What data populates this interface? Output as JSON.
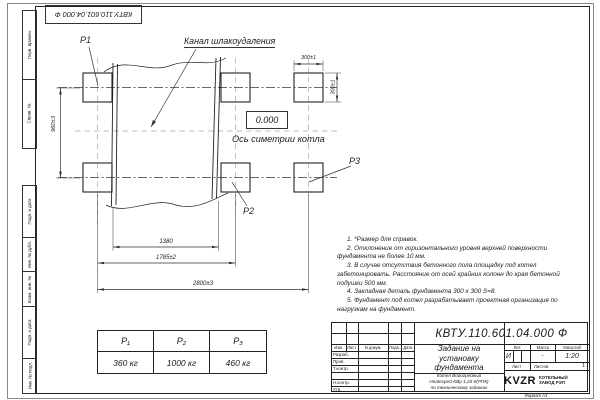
{
  "margin": {
    "top_stamp": "КВТУ.110.601.04.000  Ф",
    "fields_top": [
      "Перв. примен.",
      "Справ. №"
    ],
    "fields_bottom": [
      "Подп. и дата",
      "Инв. № дубл.",
      "Взам. инв. №",
      "Подп. и дата",
      "Инв. № подл."
    ]
  },
  "drawing": {
    "p1": "P1",
    "p2": "P2",
    "p3": "P3",
    "channel_label": "Канал шлакоудаления",
    "level_mark": "0.000",
    "axis_label": "Ось симетрии котла",
    "dims": {
      "pad_width": "300±1",
      "pad_height": "300±1",
      "row_spacing": "960±3",
      "channel_width": "1380",
      "columns_mid": "1785±2",
      "columns_overall": "2800±3"
    }
  },
  "notes": [
    "1. *Размер для справок.",
    "2. Отклонение от горизонтального уровня верхней поверхности фундамента не более 10 мм.",
    "3. В случае отсутствия бетонного пола площадку под котел забетонировать. Расстояние от осей крайних колонн до края бетонной подушки 500 мм.",
    "4. Закладная деталь фундамента 300 x 300 S=8.",
    "5. Фундамент под котел разрабатывает проектная организация по нагрузкам на фундамент."
  ],
  "load_table": {
    "headers": [
      "P₁",
      "P₂",
      "P₃"
    ],
    "values": [
      "360 кг",
      "1000 кг",
      "460 кг"
    ]
  },
  "title_block": {
    "designation": "КВТУ.110.601.04.000  Ф",
    "title_lines": [
      "Задание на",
      "установку",
      "фундамента"
    ],
    "subtitle_lines": [
      "Котел Водогрейный",
      "Heatexpert-КВр-1,25-К(РПК)",
      "по техническому заданию"
    ],
    "rev_cols": [
      "Изм.",
      "Лист",
      "N докум.",
      "Подп.",
      "Дата"
    ],
    "roles": [
      "Разраб.",
      "Пров.",
      "Т.контр.",
      "",
      "Н.контр.",
      "Утв."
    ],
    "lit_label": "Лит.",
    "lit_value": "И",
    "mass_label": "Масса",
    "mass_value": "-",
    "scale_label": "Масштаб",
    "scale_value": "1:20",
    "sheet_label": "Лист",
    "sheets_label": "Листов",
    "sheets_value": "1",
    "logo_text": "KVZR",
    "logo_sub1": "КОТЕЛЬНЫЙ",
    "logo_sub2": "ЗАВОД РЭП"
  },
  "format_label": "Формат А3"
}
